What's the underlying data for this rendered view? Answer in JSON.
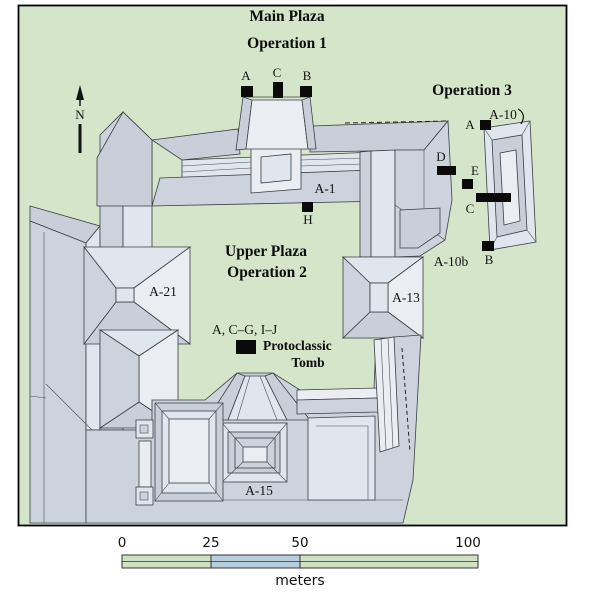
{
  "titles": {
    "main_plaza": "Main Plaza",
    "operation1": "Operation 1",
    "operation3": "Operation 3",
    "upper_plaza": "Upper Plaza",
    "operation2": "Operation 2"
  },
  "structures": {
    "a1": "A-1",
    "a21": "A-21",
    "a13": "A-13",
    "a15": "A-15",
    "a10": "A-10",
    "a10b": "A-10b"
  },
  "units": {
    "op1_a": "A",
    "op1_c": "C",
    "op1_b": "B",
    "op2_h": "H",
    "op3_a": "A",
    "op3_b": "B",
    "op3_c": "C",
    "op3_d": "D",
    "op3_e": "E"
  },
  "tomb": {
    "units": "A, C–G, I–J",
    "name_line1": "Protoclassic",
    "name_line2": "Tomb"
  },
  "compass": {
    "north": "N"
  },
  "scale_bar": {
    "tick0": "0",
    "tick25": "25",
    "tick50": "50",
    "tick100": "100",
    "unit": "meters"
  },
  "colors": {
    "plaza_green": "#d5e5c9",
    "building_top": "#dfe6ed",
    "building_highlight": "#eaedf2",
    "building_slope": "#c8cfd9",
    "building_mid": "#ccd3dc",
    "scale_green": "#cfe0c3",
    "scale_blue": "#b7cedf",
    "marker_black": "#0a0a0a"
  }
}
